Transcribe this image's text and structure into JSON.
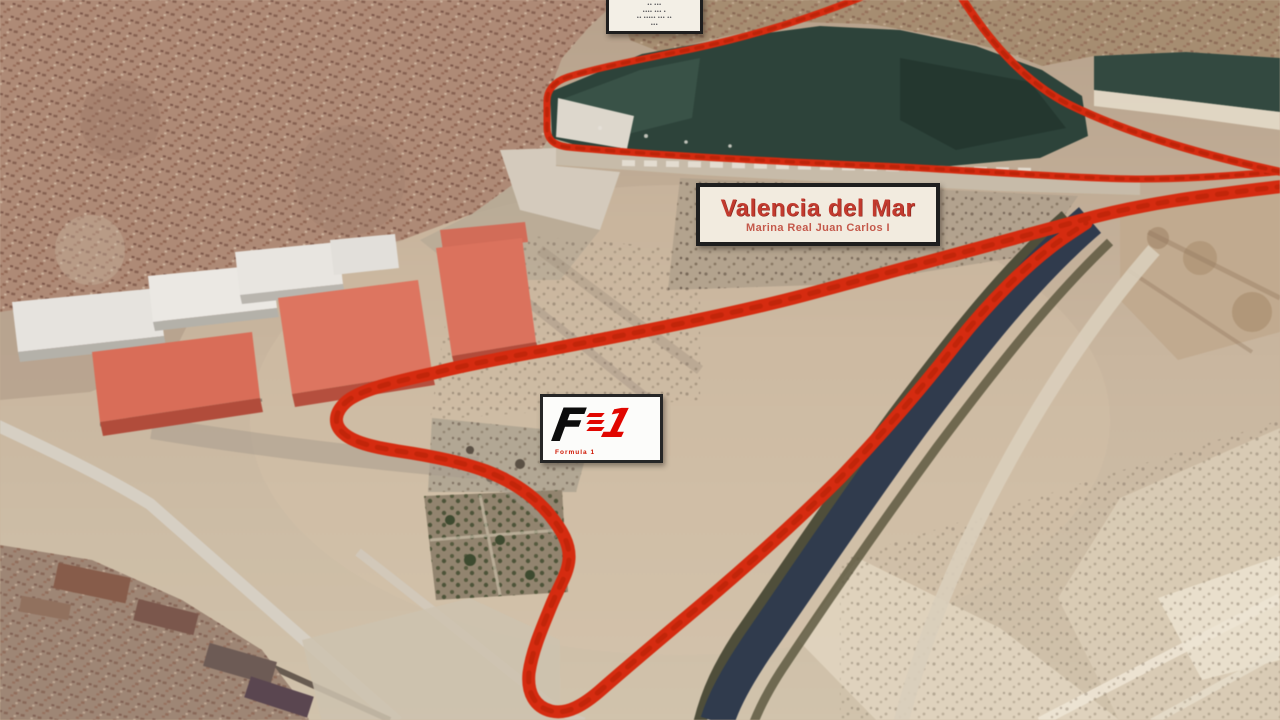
{
  "overlay": {
    "top_box": {
      "lines": [
        "•• •••",
        "•••• ••• •",
        "•• ••••• ••• ••",
        "•••"
      ]
    },
    "location_box": {
      "title": "Valencia del Mar",
      "subtitle": "Marina Real Juan Carlos I"
    },
    "f1_box": {
      "letter": "F",
      "digit": "1",
      "caption": "Formula 1"
    }
  },
  "colors": {
    "track": "#e0280a",
    "track_dash": "#bc1e00",
    "basin_water": "#2b4339",
    "canal_water": "#2e3a4e",
    "title_red": "#c23a2e",
    "subtitle_red": "#c04a3c",
    "f1_red": "#e10600",
    "caption_red": "#cf1602"
  }
}
